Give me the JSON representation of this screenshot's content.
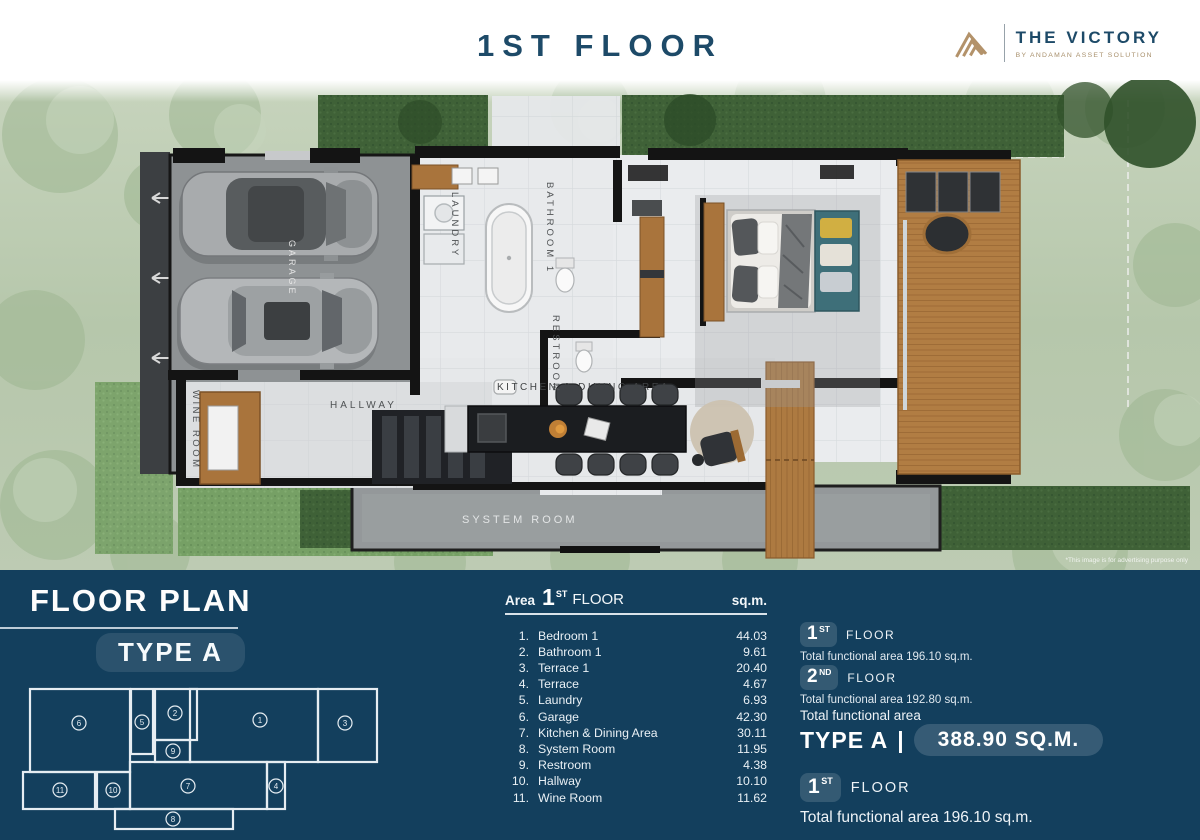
{
  "header": {
    "title": "1ST FLOOR",
    "brand": {
      "name": "THE VICTORY",
      "tagline": "BY ANDAMAN ASSET SOLUTION"
    }
  },
  "plan": {
    "labels": {
      "garage": "GARAGE",
      "laundry": "LAUNDRY",
      "bathroom1": "BATHROOM 1",
      "restroom": "RESTROOM",
      "kitchen_dining": "KITCHEN & DINING AREA",
      "hallway": "HALLWAY",
      "wine_room": "WINE ROOM",
      "system_room": "SYSTEM ROOM"
    },
    "disclaimer": "*This image is for advertising purpose only"
  },
  "footer": {
    "title": "FLOOR PLAN",
    "type_badge": "TYPE A",
    "area_table": {
      "area_label": "Area",
      "floor_num": "1",
      "floor_ord": "ST",
      "floor_word": "FLOOR",
      "unit": "sq.m.",
      "rows": [
        {
          "num": "1.",
          "name": "Bedroom 1",
          "value": "44.03"
        },
        {
          "num": "2.",
          "name": "Bathroom 1",
          "value": "9.61"
        },
        {
          "num": "3.",
          "name": "Terrace 1",
          "value": "20.40"
        },
        {
          "num": "4.",
          "name": "Terrace",
          "value": "4.67"
        },
        {
          "num": "5.",
          "name": "Laundry",
          "value": "6.93"
        },
        {
          "num": "6.",
          "name": "Garage",
          "value": "42.30"
        },
        {
          "num": "7.",
          "name": "Kitchen & Dining Area",
          "value": "30.11"
        },
        {
          "num": "8.",
          "name": "System Room",
          "value": "11.95"
        },
        {
          "num": "9.",
          "name": "Restroom",
          "value": "4.38"
        },
        {
          "num": "10.",
          "name": "Hallway",
          "value": "10.10"
        },
        {
          "num": "11.",
          "name": "Wine Room",
          "value": "11.62"
        }
      ]
    },
    "floor_summaries": [
      {
        "num": "1",
        "ord": "ST",
        "word": "FLOOR",
        "text": "Total functional area 196.10 sq.m."
      },
      {
        "num": "2",
        "ord": "ND",
        "word": "FLOOR",
        "text": "Total functional area 192.80 sq.m."
      }
    ],
    "total": {
      "label": "Total functional area",
      "type_name": "TYPE A",
      "separator": "|",
      "value": "388.90 SQ.M."
    },
    "highlight": {
      "num": "1",
      "ord": "ST",
      "word": "FLOOR",
      "text": "Total functional area 196.10 sq.m."
    },
    "minimap": {
      "rooms": [
        {
          "num": "1"
        },
        {
          "num": "2"
        },
        {
          "num": "3"
        },
        {
          "num": "4"
        },
        {
          "num": "5"
        },
        {
          "num": "6"
        },
        {
          "num": "7"
        },
        {
          "num": "8"
        },
        {
          "num": "9"
        },
        {
          "num": "10"
        },
        {
          "num": "11"
        }
      ]
    }
  },
  "colors": {
    "footer_navy": "#133f5d",
    "brand_gold": "#b3926a",
    "title_navy": "#1d4a68"
  }
}
